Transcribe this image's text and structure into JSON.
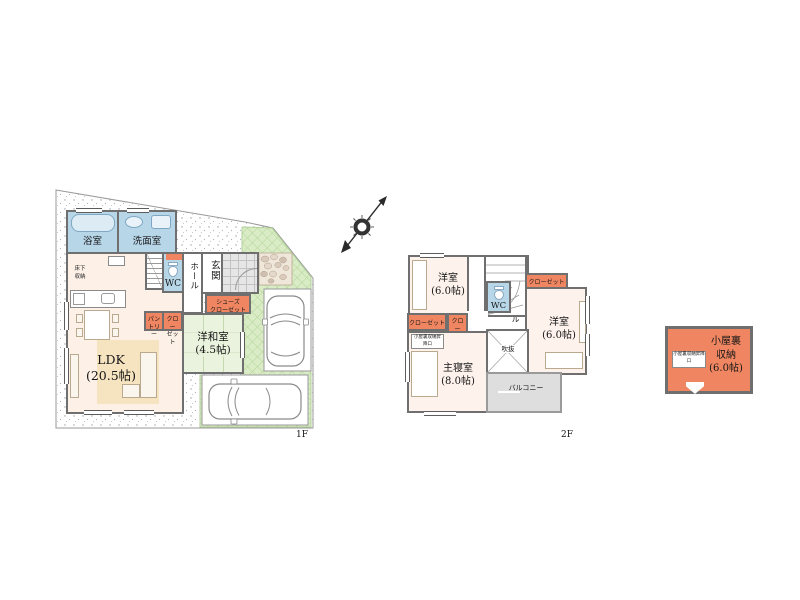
{
  "floor1": {
    "label": "1F",
    "bath": "浴室",
    "wash": "洗面室",
    "wc": "WC",
    "hall": "ホール",
    "entrance": "玄関",
    "shoes_line1": "シューズ",
    "shoes_line2": "クローゼット",
    "pantry_line1": "パン",
    "pantry_line2": "トリー",
    "closet_line1": "クロー",
    "closet_line2": "ゼット",
    "underfloor_line1": "床下",
    "underfloor_line2": "収納",
    "tatami_room": "洋和室",
    "tatami_size": "(4.5帖)",
    "ldk": "LDK",
    "ldk_size": "(20.5帖)"
  },
  "floor2": {
    "label": "2F",
    "bedroom1": "洋室",
    "bedroom1_size": "(6.0帖)",
    "bedroom2": "洋室",
    "bedroom2_size": "(6.0帖)",
    "master": "主寝室",
    "master_size": "(8.0帖)",
    "wc": "WC",
    "hall": "ホール",
    "closet_top": "クローゼット",
    "closet_left": "クローゼット",
    "closet_small_line1": "クロー",
    "closet_small_line2": "ゼット",
    "void": "吹抜",
    "balcony": "バルコニー",
    "attic_hatch": "小屋裏収納昇降口"
  },
  "attic": {
    "line1": "小屋裏",
    "line2": "収納",
    "size": "(6.0帖)",
    "hatch": "小屋裏収納昇降口"
  },
  "colors": {
    "closet_salmon": "#EF8661",
    "wet_room_blue": "#B7D7E9",
    "ldk_floor": "#FDF0E7",
    "tatami_green": "#EAF3DD",
    "garden_green": "#D9ECC5",
    "rug_beige": "#F6E3C0",
    "balcony_grey": "#DEDEDE",
    "wall_grey": "#6F6F6F"
  }
}
